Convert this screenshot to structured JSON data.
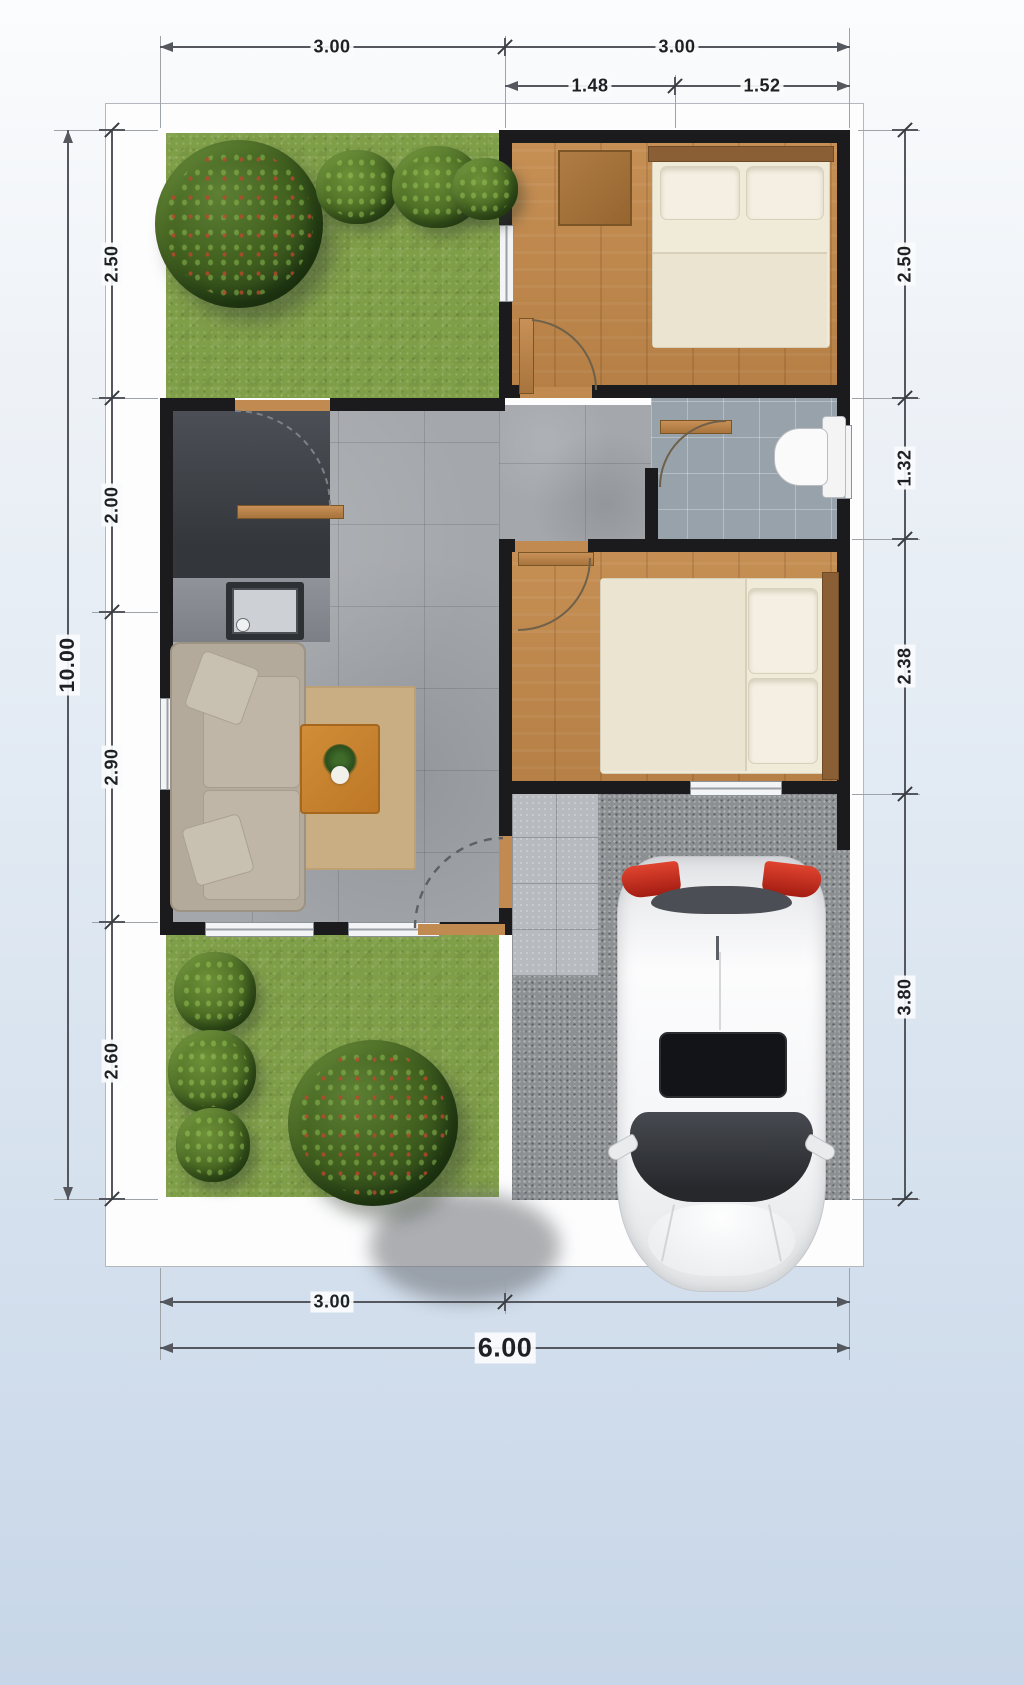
{
  "dimensions": {
    "top_primary": [
      "3.00",
      "3.00"
    ],
    "top_secondary": [
      "1.48",
      "1.52"
    ],
    "left_segments": [
      "2.50",
      "2.00",
      "2.90",
      "2.60"
    ],
    "left_overall": "10.00",
    "right_segments": [
      "2.50",
      "1.32",
      "2.38",
      "3.80"
    ],
    "bottom_segments": [
      "3.00"
    ],
    "bottom_overall": "6.00"
  },
  "colors": {
    "wall": "#1b1b1d",
    "grass": "#7f9e48",
    "wood_floor": "#c08a50",
    "hall_tile": "#a4a7ab",
    "bathroom_tile": "#98a2aa",
    "kitchen_counter": "#3d4045",
    "carport_concrete": "#8d9093",
    "dimension_line": "#54585e",
    "car_body": "#f2f3f5",
    "taillight_red": "#c0392b",
    "rug": "#c9ae83",
    "coffee_table": "#c8832f",
    "sofa": "#b3aa9b"
  },
  "objects": {
    "plan": "house-floor-plan-top-view",
    "zones": [
      "front-garden",
      "bedroom-1",
      "kitchen",
      "hallway",
      "bathroom",
      "living-room",
      "bedroom-2",
      "back-garden",
      "carport"
    ],
    "furniture": [
      "double-bed",
      "single-bed",
      "wardrobe-cabinet",
      "sofa",
      "coffee-table",
      "house-plant",
      "kitchen-sink",
      "toilet",
      "car"
    ]
  }
}
